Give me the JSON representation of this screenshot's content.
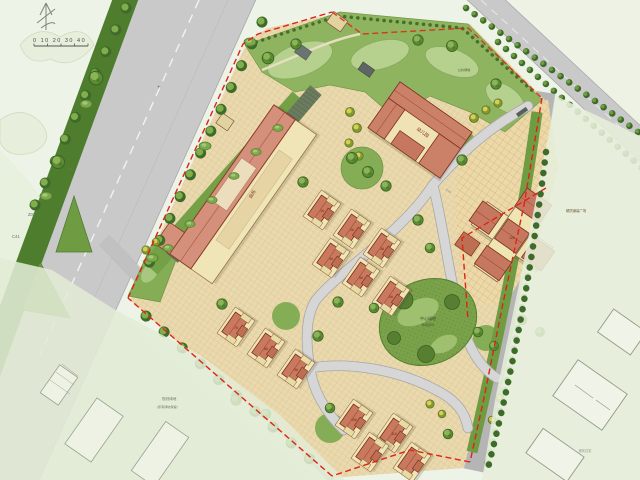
{
  "plan": {
    "scalebar": "0 10 20 30 40",
    "survey_mark": "+",
    "road_codes": {
      "z03": "Z03",
      "c41": "C41"
    },
    "labels": {
      "club": "会所",
      "kindergarten": "幼儿园",
      "central_green_1": "中心绿地",
      "central_green_2": "休闲草坪",
      "plaza": "硬质铺装广场",
      "park": "公共绿地",
      "note_1": "规划绿地",
      "note_2": "(原有绿地保留)",
      "context": "现状住宅",
      "dim": "6.00"
    },
    "unit_labels": [
      "1#",
      "2#",
      "3#",
      "4#",
      "5#",
      "6#",
      "7#",
      "8#",
      "9#",
      "10#",
      "11#",
      "12#"
    ],
    "colors": {
      "boundary_red": "#e02314",
      "paving_tan": "#ead9ad",
      "lawn_green": "#8fb45f",
      "roof_red": "#c8795e",
      "podium_cream": "#efe5b6",
      "road_gray": "#c9c9c9",
      "verge_green": "#4e7d2e",
      "context_fade": "#e6eed9"
    }
  }
}
